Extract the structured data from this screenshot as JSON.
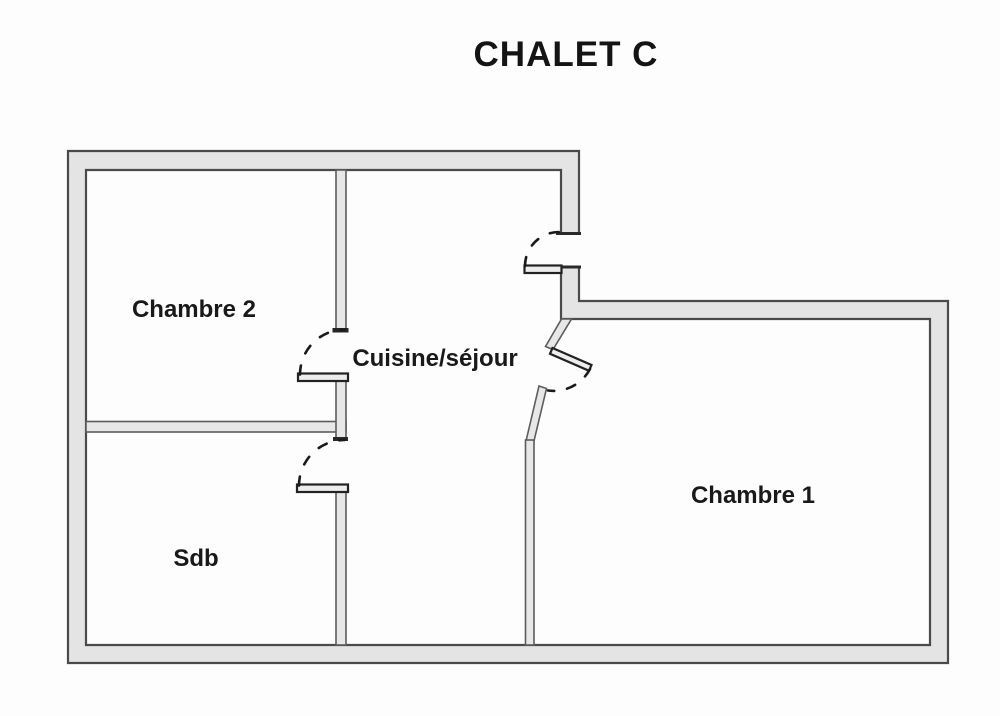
{
  "title": "CHALET C",
  "plan": {
    "rooms": [
      {
        "id": "chambre2",
        "label": "Chambre 2"
      },
      {
        "id": "cuisine_sejour",
        "label": "Cuisine/séjour"
      },
      {
        "id": "chambre1",
        "label": "Chambre 1"
      },
      {
        "id": "sdb",
        "label": "Sdb"
      }
    ],
    "doors": [
      {
        "name": "entrance-door",
        "connects": "exterior → Cuisine/séjour"
      },
      {
        "name": "chambre2-door",
        "connects": "Cuisine/séjour → Chambre 2"
      },
      {
        "name": "sdb-door",
        "connects": "Cuisine/séjour → Sdb"
      },
      {
        "name": "chambre1-door",
        "connects": "Cuisine/séjour → Chambre 1"
      }
    ]
  },
  "colors": {
    "background": "#fdfdfd",
    "wall_fill": "#e4e4e4",
    "wall_outline": "#4a4a4a",
    "interior_wall_fill": "#e7e7e7",
    "door_leaf_fill": "#ededed",
    "door_arc": "#1a1a1a",
    "text": "#141414"
  }
}
